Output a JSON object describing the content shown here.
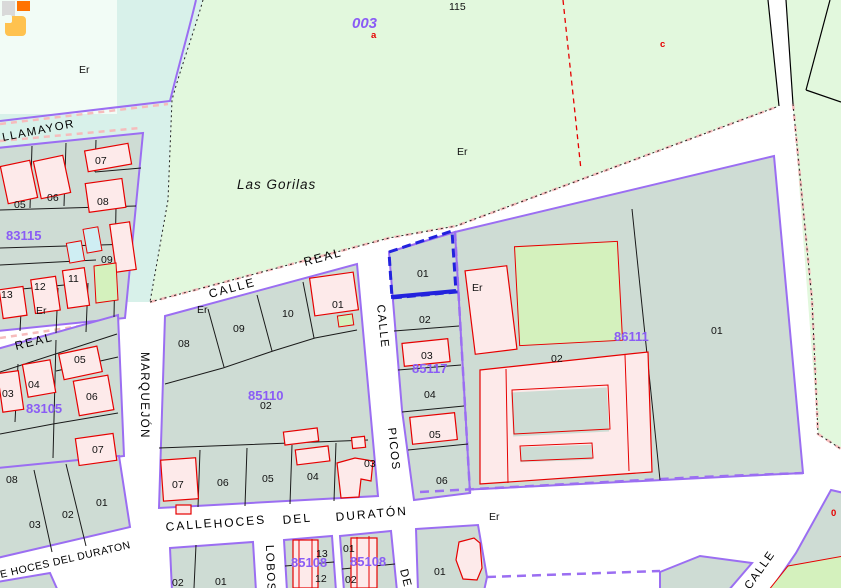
{
  "rural": {
    "code": "003",
    "sub_a": "a",
    "sub_c": "c",
    "name": "Las Gorilas",
    "parcel_115": "115",
    "er": "Er"
  },
  "topleft": {
    "er": "Er"
  },
  "streets": {
    "villamayor": "LLAMAYOR",
    "real_short": "REAL",
    "calle_real_c": "CALLE",
    "calle_real_r": "REAL",
    "marquejon": "MARQUEJÓN",
    "picos_calle": "CALLE",
    "picos": "PICOS",
    "hoces_calle": "CALLE",
    "hoces": "HOCES",
    "hoces_del": "DEL",
    "duraton": "DURATÓN",
    "er_duraton": "Er",
    "hoces_lower": "E HOCES DEL DURATON",
    "lobos": "LOBOS",
    "de": "DE",
    "calle_br": "CALLE"
  },
  "blocks": {
    "b83115": {
      "code": "83115",
      "p05": "05",
      "p06": "06",
      "p07": "07",
      "p08": "08",
      "p09": "09",
      "p11": "11",
      "p12": "12",
      "p13": "13",
      "er": "Er"
    },
    "b83105": {
      "code": "83105",
      "p03": "03",
      "p04": "04",
      "p05": "05",
      "p06": "06",
      "p07": "07"
    },
    "b85110": {
      "code": "85110",
      "p08": "08",
      "p09": "09",
      "p10": "10",
      "p01": "01",
      "p02": "02",
      "p03": "03",
      "p04": "04",
      "p05": "05",
      "p06": "06",
      "p07": "07",
      "er": "Er"
    },
    "b85117": {
      "code": "85117",
      "p01": "01",
      "p02": "02",
      "p03": "03",
      "p04": "04",
      "p05": "05",
      "p06": "06"
    },
    "b86111": {
      "code": "86111",
      "p01": "01",
      "p02": "02",
      "er": "Er"
    },
    "bsw": {
      "p08": "08",
      "p03": "03",
      "p02": "02",
      "p01": "01"
    },
    "bs2": {
      "p01": "01",
      "p02": "02"
    },
    "b85108a": {
      "code": "85108",
      "p13": "13",
      "p12": "12"
    },
    "b85108b": {
      "code": "85108",
      "p01": "01",
      "p02": "02"
    },
    "bs01": {
      "p01": "01"
    },
    "bse": {
      "p0": "0"
    }
  },
  "colors": {
    "purple": "#9b6ef2",
    "purple_text": "#8a5cf5",
    "teal": "#cedcd4",
    "rural_green": "#e2f8dd",
    "cyan_zone": "#d8f1ea",
    "patch": "#f2fcf6",
    "building_pink": "#fdeaea",
    "building_red": "#e60000",
    "pink_dash": "#f6bcbc",
    "selection_blue": "#2222dd",
    "subparcel_green": "#d4f1bd",
    "cyan_building": "#cfeef3",
    "logo_grey": "#d9d9d9",
    "logo_orange": "#ff7300",
    "logo_amber": "#ffc24f",
    "label_black": "#111111"
  }
}
